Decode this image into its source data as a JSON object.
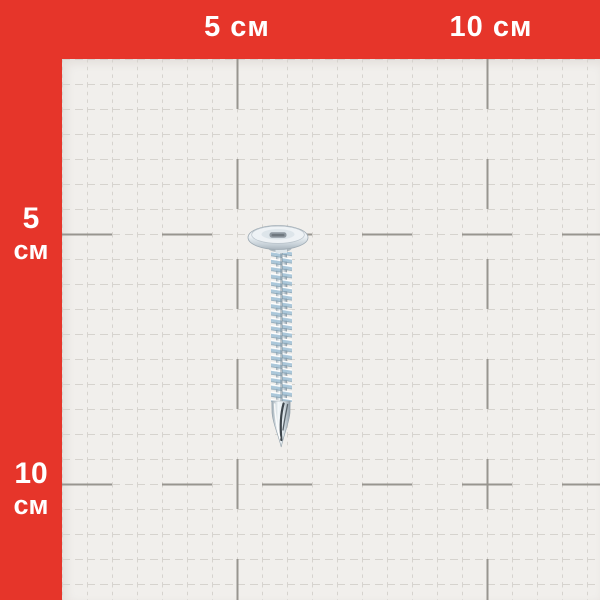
{
  "image": {
    "type": "product-photo",
    "subject": "zinc-plated self-drilling screw on centimetre measurement grid"
  },
  "colors": {
    "frame-red": "#e6352a",
    "paper": "#f1efec",
    "grid-minor": "#d6d3ce",
    "grid-major": "#98958f",
    "label-text": "#ffffff",
    "metal-highlight": "#ffffff",
    "metal-light": "#eef2f5",
    "metal-blue": "#aac7da",
    "metal-mid": "#b6c2cb",
    "metal-dark": "#7f8f9b",
    "flute-dark": "#3d454b"
  },
  "ruler": {
    "unit": "см",
    "top_labels": [
      {
        "text": "5 см",
        "position_cm": 5
      },
      {
        "text": "10 см",
        "position_cm": 10
      }
    ],
    "left_labels": [
      {
        "number": "5",
        "unit": "см",
        "position_cm": 5
      },
      {
        "number": "10",
        "unit": "см",
        "position_cm": 10
      }
    ],
    "minor_cell_cm": 0.5,
    "major_tick_cm": 5
  }
}
